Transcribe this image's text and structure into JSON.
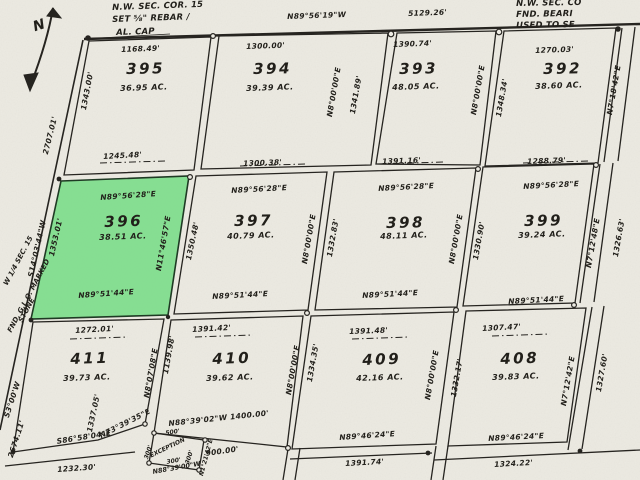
{
  "colors": {
    "paper": "#edebe3",
    "ink": "#262420",
    "highlight": "#7ddc8b"
  },
  "north_label": "N",
  "corner_notes": {
    "nw": [
      "N.W. SEC. COR. 15",
      "SET ⅝\" REBAR /",
      "AL. CAP"
    ],
    "ne": [
      "N.W. SEC. CO",
      "FND. BEARI",
      "USED TO SE"
    ]
  },
  "section_line": {
    "bearing": "N89°56'19\"W",
    "distance": "5129.26'"
  },
  "west_boundary": {
    "bearing": "S14°03'44\"W",
    "distance_upper": "2707.01'",
    "bearing_lower": "S3°00'W",
    "distance_lower": "2674.11'",
    "quarter_note": [
      "W 1/4 SEC. 15",
      "FND. G.L.O. MARKED",
      "STONE"
    ]
  },
  "lots": {
    "395": {
      "number": "395",
      "area": "36.95 AC.",
      "top": "1168.49'",
      "bottom": "1245.48'",
      "left": "1343.00'"
    },
    "394": {
      "number": "394",
      "area": "39.39 AC.",
      "top": "1300.00'",
      "bottom": "1300.38'"
    },
    "393": {
      "number": "393",
      "area": "48.05 AC.",
      "top": "1390.74'",
      "bottom": "1391.16'"
    },
    "392": {
      "number": "392",
      "area": "38.60 AC.",
      "top": "1270.03'",
      "bottom": "1288.79'"
    },
    "396": {
      "number": "396",
      "area": "38.51 AC.",
      "top_bearing": "N89°56'28\"E",
      "bottom_bearing": "N89°51'44\"E",
      "left": "1353.01'",
      "right_bearing": "N11°46'57\"E"
    },
    "397": {
      "number": "397",
      "area": "40.79 AC.",
      "top_bearing": "N89°56'28\"E",
      "bottom_bearing": "N89°51'44\"E",
      "left": "1350.48'"
    },
    "398": {
      "number": "398",
      "area": "48.11 AC.",
      "top_bearing": "N89°56'28\"E",
      "bottom_bearing": "N89°51'44\"E"
    },
    "399": {
      "number": "399",
      "area": "39.24 AC.",
      "top_bearing": "N89°56'28\"E",
      "bottom_bearing": "N89°51'44\"E"
    },
    "411": {
      "number": "411",
      "area": "39.73 AC.",
      "top": "1272.01'",
      "left": "1337.05'",
      "bottom_bearing": "S86°58'04\"E",
      "diag_bearing": "N73°39'35\"E"
    },
    "410": {
      "number": "410",
      "area": "39.62 AC.",
      "top": "1391.42'",
      "bottom": "N88°39'02\"W 1400.00'"
    },
    "409": {
      "number": "409",
      "area": "42.16 AC.",
      "top": "1391.48'",
      "bottom_bearing": "N89°46'24\"E",
      "below": "1391.74'"
    },
    "408": {
      "number": "408",
      "area": "39.83 AC.",
      "top": "1307.47'",
      "bottom_bearing": "N89°46'24\"E",
      "below": "1324.22'"
    }
  },
  "roads": {
    "r394_393": {
      "bearing": "N8°00'00\"E",
      "length": "1341.89'"
    },
    "r393_392": {
      "bearing": "N8°00'00\"E",
      "length": "1348.34'"
    },
    "r392_e": {
      "bearing": "N7°18'42\"E"
    },
    "r397_398": {
      "bearing": "N8°00'00\"E",
      "length": "1332.83'"
    },
    "r398_399": {
      "bearing": "N8°00'00\"E",
      "length": "1330.90'"
    },
    "r399_e": {
      "bearing": "N7°12'48\"E",
      "length": "1326.63'"
    },
    "r411_410": {
      "bearing": "N8°07'08\"E",
      "length": "1139.98'"
    },
    "r410_409": {
      "bearing": "N8°00'00\"E",
      "length": "1334.35'"
    },
    "r409_408": {
      "bearing": "N8°00'00\"E",
      "length": "1332.17'"
    },
    "r408_e": {
      "bearing": "N7°12'42\"E",
      "length": "1327.60'"
    }
  },
  "exception": {
    "label": "EXCEPTION",
    "top": "500'",
    "left": "300'",
    "bottom": "300'",
    "right": "300'",
    "bearing": "N88°39'00\"W",
    "side_bearing": "N1°21'42\"E",
    "south_dist": "900.00'"
  },
  "partial": {
    "below_411": "1232.30'"
  }
}
